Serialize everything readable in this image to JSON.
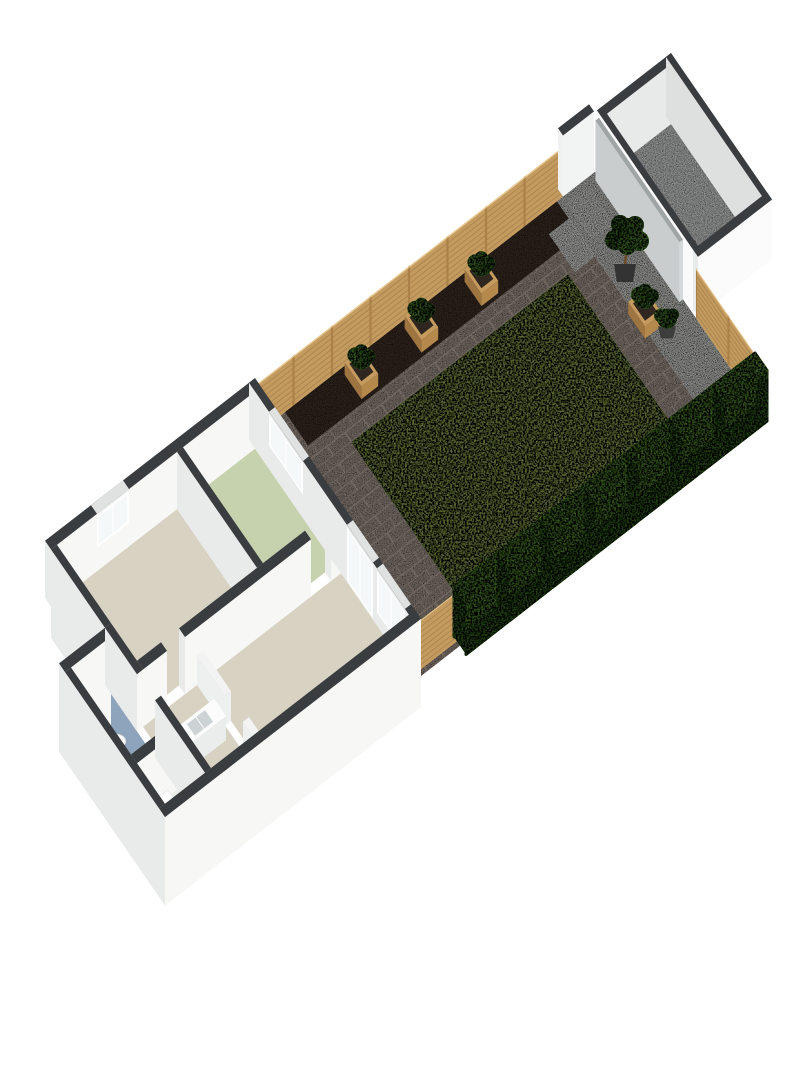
{
  "meta": {
    "description": "3D isometric floor plan render: ground floor with rear garden and outbuilding",
    "background": "#ffffff"
  },
  "palette": {
    "wallTop": "#3a3d40",
    "wallFaceSE": "#f7f7f6",
    "wallFaceSW": "#e9eaea",
    "wallHalfTop": "#f2f3f2",
    "wallHalfFace": "#eef0f0",
    "floorBeige": "#d7d2c2",
    "floorGreen": "#c6d2ae",
    "floorBlue": "#8ea4bd",
    "floorPale": "#eaeae8",
    "showerTray": "#e3e7e9",
    "frame": "#ffffff",
    "pane": "#f4f8f9",
    "topGap": "#e0e1e1",
    "paving": "#9b8e86",
    "pavingJoint": "#84786f",
    "soil": "#41332a",
    "gravel": "#d3d4d0",
    "pad": "#dadbd7",
    "lawn": "#92a957",
    "lawnEdge": "#7f9447",
    "wood": "#c49b5f",
    "woodLine": "#96703f",
    "woodPost": "#ab8149",
    "woodTop": "#e6c489",
    "hedge": "#568733",
    "hedgeDark": "#3c6a24",
    "hedgeTop": "#63973b",
    "gate": "#c9cdce",
    "gateTop": "#9fa4a5",
    "shedFloor": "#c5c7c6",
    "shedInnerA": "#e8e9e9",
    "shedInnerB": "#dedfdf",
    "counterSide": "#ebecec",
    "counterTop": "#fcfcfc",
    "sink": "#cdd2d4",
    "fixtureWhite": "#fdfdfd",
    "fixtureEdge": "#e1e1e1",
    "cabinetWood": "#9c6b3e",
    "cabinetWoodDark": "#8a5c33",
    "potDark": "#333333",
    "potGray": "#3d3d3d",
    "trunk": "#6b4a2a",
    "leaf": "#4a7c2f",
    "leafDark": "#3c6b26",
    "leafLight": "#578c36",
    "radiator": "#c23e74",
    "doorRed": "#86322c",
    "planterWood": "#b5894c",
    "planterWoodDark": "#9e7440",
    "planterRim": "#c59a5e",
    "planterSoil": "#2f261f"
  },
  "view": {
    "ax": 20,
    "ay": -15.5,
    "bx": 20,
    "by": 29,
    "hs": 26,
    "x0": 45,
    "y0": 598
  },
  "garden": {
    "paving": [
      10.5,
      27.5,
      0,
      8.3
    ],
    "soil": [
      12.0,
      25.6,
      0,
      1.15
    ],
    "gravel": [
      [
        25.6,
        27.5,
        0,
        8.3
      ],
      [
        22.8,
        25.6,
        7.6,
        8.3
      ]
    ],
    "pads": [
      [
        24.6,
        25.6,
        0.6,
        1.9
      ],
      [
        25.9,
        26.9,
        0.25,
        1.45
      ]
    ],
    "lawn": [
      13.5,
      24.3,
      1.85,
      8.0
    ],
    "fence_nw": {
      "a": [
        10.5,
        0
      ],
      "b": [
        25.9,
        0
      ],
      "h": 1.85
    },
    "fence_cross": {
      "a": [
        27.5,
        5.05
      ],
      "b": [
        27.5,
        8.3
      ],
      "h": 1.85
    },
    "fence_corner": {
      "a": [
        10.5,
        8.15
      ],
      "b": [
        12.45,
        8.15
      ],
      "h": 1.85
    },
    "white_wall": {
      "r": [
        25.9,
        27.45,
        -0.25,
        0
      ],
      "h": 2.35
    },
    "gate": {
      "r": [
        27.32,
        27.5,
        0.2,
        4.4
      ],
      "h": 2.3
    },
    "hedge": {
      "u1": 12.45,
      "u2": 27.5,
      "v1": 8.0,
      "v2": 8.6,
      "h": 1.95,
      "blocks": 7
    },
    "planters": [
      {
        "u": 15.2,
        "v": 0.62
      },
      {
        "u": 18.2,
        "v": 0.62
      },
      {
        "u": 21.2,
        "v": 0.62
      },
      {
        "u": 25.8,
        "v": 4.2
      }
    ],
    "tree": {
      "u": 26.0,
      "v": 3.0
    },
    "pots": [
      {
        "u": 26.1,
        "v": 5.0
      }
    ]
  },
  "outbuilding": {
    "outer": [
      27.6,
      31.3,
      0,
      5.05
    ],
    "t": 0.25,
    "h": 2.3
  },
  "house": {
    "wall_h": 2.2,
    "half_h": 1.15,
    "plinth": 1.2,
    "floors": [
      {
        "name": "floor-front-room",
        "r": [
          0.3,
          6.3,
          0.3,
          4.3
        ],
        "c": "floorBeige"
      },
      {
        "name": "floor-kitchen",
        "r": [
          6.6,
          10.2,
          0.3,
          4.3
        ],
        "c": "floorGreen"
      },
      {
        "name": "floor-living-room",
        "r": [
          3.3,
          10.2,
          4.6,
          8.0
        ],
        "c": "floorBeige"
      },
      {
        "name": "floor-hallway",
        "r": [
          0.3,
          3.0,
          4.6,
          8.0
        ],
        "c": "floorBeige"
      },
      {
        "name": "floor-bathroom",
        "r": [
          -2.0,
          0,
          3.3,
          6.3
        ],
        "c": "floorBlue"
      },
      {
        "name": "floor-storage",
        "r": [
          -2.0,
          0,
          6.6,
          8.0
        ],
        "c": "floorPale"
      },
      {
        "name": "shower-tray",
        "r": [
          -1.95,
          -1.05,
          5.3,
          6.2
        ],
        "c": "showerTray"
      }
    ],
    "walls": [
      {
        "name": "wall-nw",
        "r": [
          0,
          10.5,
          0,
          0.3
        ],
        "win": [
          {
            "side": "v",
            "span": [
              2.3,
              3.9
            ],
            "h": [
              0.9,
              2.1
            ],
            "m": 2
          }
        ]
      },
      {
        "name": "wall-garden",
        "r": [
          10.2,
          10.5,
          0,
          8.3
        ],
        "win": [
          {
            "side": "u",
            "span": [
              1.0,
              2.7
            ],
            "h": [
              0.9,
              2.1
            ],
            "m": 2
          },
          {
            "side": "u",
            "span": [
              4.9,
              6.2
            ],
            "h": [
              0.05,
              2.1
            ],
            "m": 2
          },
          {
            "side": "u",
            "span": [
              6.4,
              7.8
            ],
            "h": [
              0.5,
              2.1
            ],
            "m": 2
          }
        ]
      },
      {
        "name": "wall-se",
        "r": [
          -2.3,
          10.5,
          8.0,
          8.3
        ],
        "p": true
      },
      {
        "name": "wall-sw",
        "r": [
          0,
          0.3,
          0.3,
          3.0
        ],
        "p": true
      },
      {
        "name": "wall-ext-nw",
        "r": [
          -2.3,
          0,
          3.0,
          3.3
        ],
        "p": true
      },
      {
        "name": "wall-ext-sw",
        "r": [
          -2.3,
          -2.0,
          3.3,
          8.0
        ],
        "p": true
      },
      {
        "name": "wall-join-a",
        "r": [
          0,
          0.3,
          3.0,
          4.6
        ]
      },
      {
        "name": "wall-join-b",
        "r": [
          0,
          0.3,
          5.5,
          8.0
        ]
      },
      {
        "name": "wall-divider",
        "r": [
          6.3,
          6.6,
          0.3,
          4.3
        ]
      },
      {
        "name": "wall-mid-a",
        "r": [
          0.3,
          1.5,
          4.3,
          4.6
        ]
      },
      {
        "name": "wall-mid-b",
        "r": [
          2.4,
          8.7,
          4.3,
          4.6
        ]
      },
      {
        "name": "wall-mid-c",
        "r": [
          9.7,
          10.2,
          4.3,
          4.6
        ]
      },
      {
        "name": "wall-hall-a",
        "r": [
          3.0,
          3.3,
          4.6,
          6.0
        ],
        "half": true
      },
      {
        "name": "wall-hall-b",
        "r": [
          3.0,
          3.3,
          6.9,
          8.0
        ],
        "half": true
      },
      {
        "name": "wall-bath-div",
        "r": [
          -2.0,
          0,
          6.3,
          6.6
        ]
      }
    ],
    "fixtures": [
      {
        "type": "counter",
        "name": "kitchen-counter",
        "r": [
          0.5,
          2.7,
          5.75,
          6.35
        ],
        "h": 0.93,
        "sink": [
          1.25,
          2.15,
          5.85,
          6.25
        ]
      },
      {
        "type": "toilet",
        "name": "toilet",
        "u": -1.6,
        "v": 4.7
      },
      {
        "type": "basin",
        "name": "wash-basin",
        "r": [
          -0.85,
          -0.35,
          5.75,
          6.25
        ],
        "h": 0.75
      },
      {
        "type": "box",
        "name": "radiator",
        "r": [
          0.33,
          0.55,
          6.8,
          7.28
        ],
        "h": 0.55,
        "c": "radiator"
      },
      {
        "type": "box",
        "name": "appliance",
        "r": [
          -1.5,
          -0.8,
          6.95,
          7.65
        ],
        "h": 0.85,
        "c": "fixtureWhite"
      },
      {
        "type": "box",
        "name": "interior-door-red",
        "r": [
          1.15,
          1.45,
          7.62,
          7.95
        ],
        "h": 1.3,
        "c": "doorRed"
      }
    ]
  }
}
